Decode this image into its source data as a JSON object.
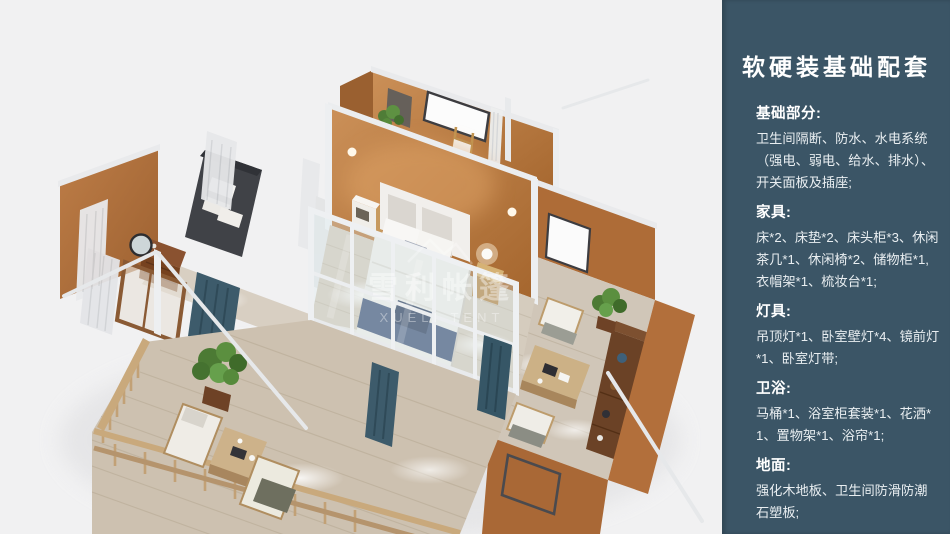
{
  "render": {
    "watermark": {
      "cn": "雪利帐篷",
      "en": "XUELI TENT"
    },
    "background_color": "#f1f1f2"
  },
  "sidebar": {
    "accent_color": "#3b5566",
    "title": "软硬装基础配套",
    "sections": [
      {
        "heading": "基础部分:",
        "body": "卫生间隔断、防水、水电系统（强电、弱电、给水、排水）、开关面板及插座;"
      },
      {
        "heading": "家具:",
        "body": "床*2、床垫*2、床头柜*3、休闲茶几*1、休闲椅*2、储物柜*1,衣帽架*1、梳妆台*1;"
      },
      {
        "heading": "灯具:",
        "body": "吊顶灯*1、卧室壁灯*4、镜前灯*1、卧室灯带;"
      },
      {
        "heading": "卫浴:",
        "body": "马桶*1、浴室柜套装*1、花洒*1、置物架*1、浴帘*1;"
      },
      {
        "heading": "地面:",
        "body": "强化木地板、卫生间防滑防潮石塑板;"
      }
    ]
  }
}
